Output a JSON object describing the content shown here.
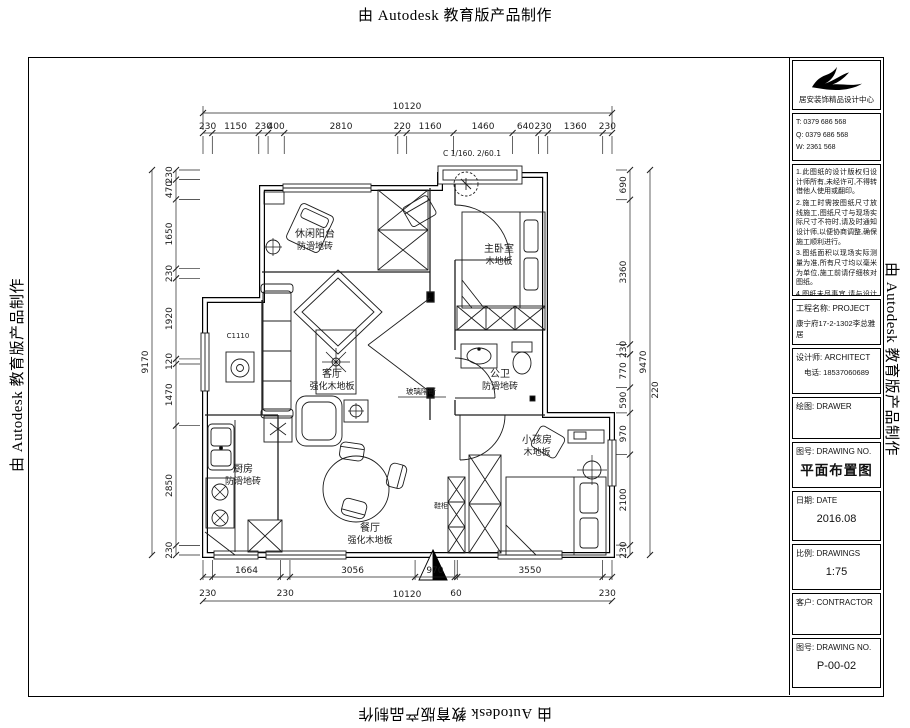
{
  "watermark": {
    "text": "由 Autodesk 教育版产品制作"
  },
  "title_block": {
    "company": "居安装饰精品设计中心",
    "contacts": [
      "T: 0379 686 568",
      "Q: 0379 686 568",
      "W: 2361 568"
    ],
    "notes": [
      "1.此图纸的设计版权归设计师所有,未经许可,不得转借他人使用或翻印。",
      "2.施工时需按图纸尺寸放线施工,图纸尺寸与现场实际尺寸不符时,请及时通知设计师,以便协商调整,确保施工顺利进行。",
      "3.图纸面积以现场实际测量为准,所有尺寸均以毫米为单位,施工前请仔细核对图纸。",
      "4.图纸未尽事宜,请与设计师联系,双方协商解决。"
    ],
    "project_label": "工程名称: PROJECT",
    "project_name": "康宁府17-2-1302李总雅居",
    "designer_label": "设计师: ARCHITECT",
    "designer_phone": "电话: 18537060689",
    "drawer_label": "绘图: DRAWER",
    "drawing_no_label": "图号: DRAWING NO.",
    "drawing_title": "平面布置图",
    "date_label": "日期: DATE",
    "date_value": "2016.08",
    "scale_label": "比例: DRAWINGS",
    "scale_value": "1:75",
    "client_label": "客户: CONTRACTOR",
    "sheet_label": "图号: DRAWING NO.",
    "sheet_value": "P-00-02"
  },
  "plan": {
    "rooms": [
      {
        "name": "休闲阳台",
        "floor": "防滑地砖"
      },
      {
        "name": "主卧室",
        "floor": "木地板"
      },
      {
        "name": "客厅",
        "floor": "强化木地板"
      },
      {
        "name": "公卫",
        "floor": "防滑地砖"
      },
      {
        "name": "厨房",
        "floor": "防滑地砖"
      },
      {
        "name": "餐厅",
        "floor": "强化木地板"
      },
      {
        "name": "小孩房",
        "floor": "木地板"
      }
    ],
    "annotations": {
      "window_top": "C 1/160. 2/60.1",
      "window_left": "C1110",
      "partition": "玻璃隔断",
      "cabinet": "鞋柜"
    }
  },
  "dimensions": {
    "top": {
      "total": "10120",
      "segments": [
        230,
        1150,
        230,
        400,
        2810,
        220,
        1160,
        1460,
        640,
        230,
        1360,
        230
      ]
    },
    "bottom": {
      "total": "10120",
      "segments": [
        230,
        1664,
        230,
        3056,
        970,
        60,
        3550,
        230
      ]
    },
    "left": {
      "total": "9170",
      "segments": [
        230,
        470,
        1650,
        230,
        1920,
        120,
        1470,
        2850,
        230
      ]
    },
    "right": {
      "total": "9470",
      "segments": [
        690,
        3360,
        230,
        770,
        590,
        970,
        2100,
        230
      ],
      "extra": "220"
    }
  }
}
